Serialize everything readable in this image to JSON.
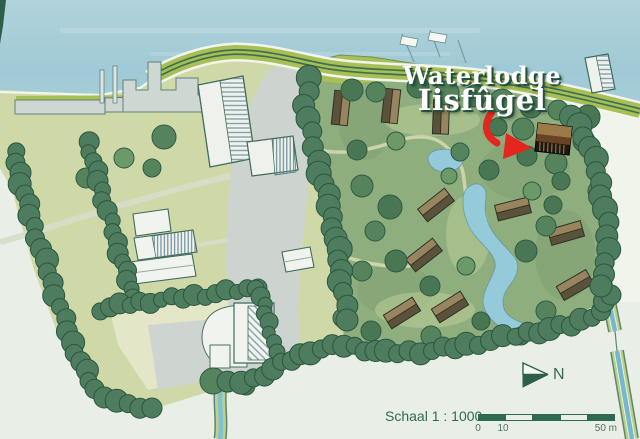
{
  "title": {
    "line1": "Waterlodge",
    "line2": "Iisfûgel"
  },
  "callout": {
    "target": "waterlodge-iisfugel-lodge",
    "arrow_color": "#e3271f"
  },
  "compass": {
    "label": "N"
  },
  "scalebar": {
    "label": "Schaal 1 : 1000",
    "ticks": [
      "0",
      "10",
      "50 m"
    ],
    "segments": 5,
    "bar_color": "#2e6a50"
  },
  "colors": {
    "water": "#a5cdd8",
    "dike_grass": "#a8bf55",
    "dike_road": "#3e7150",
    "field": "#cfd9a8",
    "park": "#8fae7e",
    "hedge": "#4d7c5e",
    "pond": "#95cadb",
    "canal_blue": "#74b7cf",
    "road": "#cdd4d0",
    "building": "#f1f4ee",
    "lodge_roof": "#98845e",
    "highlight_lodge": "#21170d",
    "background": "#e9efe6",
    "title_text": "#ffffff",
    "title_shadow": "#23503d"
  }
}
